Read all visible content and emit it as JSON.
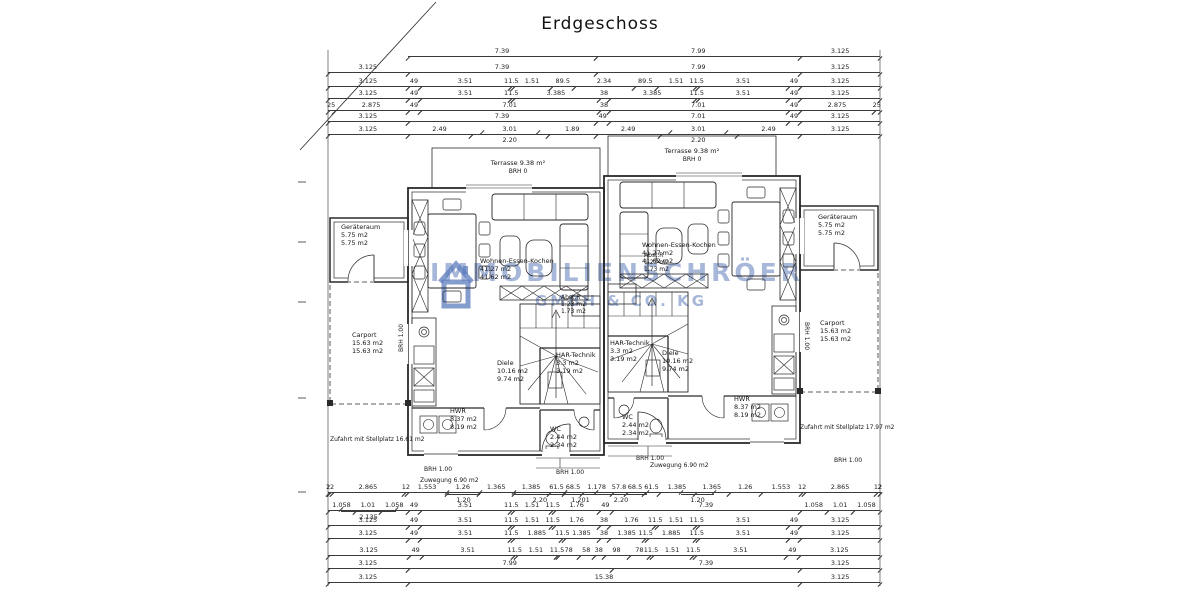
{
  "title": "Erdgeschoss",
  "watermark": {
    "part1": "IMMOBILIEN",
    "part2": "SCHRÖER",
    "sub": "GMBH & CO. KG",
    "color": "#5c7cbc"
  },
  "rooms": {
    "terrasse": {
      "name": "Terrasse 9.38 m²",
      "brh": "BRH 0"
    },
    "geraeteraum": {
      "name": "Geräteraum",
      "a1": "5.75 m2",
      "a2": "5.75 m2"
    },
    "carport": {
      "name": "Carport",
      "a1": "15.63 m2",
      "a2": "15.63 m2"
    },
    "wohnen": {
      "name": "Wohnen-Essen-Kochen",
      "a1": "41.27 m2",
      "a2": "41.62 m2"
    },
    "diele": {
      "name": "Diele",
      "a1": "10.16 m2",
      "a2": "9.74 m2"
    },
    "har": {
      "name": "HAR-Technik",
      "a1": "3.3 m2",
      "a2": "3.19 m2"
    },
    "hwr": {
      "name": "HWR",
      "a1": "8.37 m2",
      "a2": "8.19 m2"
    },
    "wc": {
      "name": "WC",
      "a1": "2.44 m2",
      "a2": "2.34 m2"
    },
    "abstr": {
      "name": "Abst.R",
      "a1": "1.23 m2",
      "a2": "1.73 m2"
    }
  },
  "site": {
    "zufahrt_links": "Zufahrt mit Stellplatz 16.61 m2",
    "zufahrt_rechts": "Zufahrt mit Stellplatz 17.97 m2",
    "zuwegung": "Zuwegung 6.90 m2",
    "brh_fenster": "BRH 1.00"
  },
  "dims": {
    "x0": 328,
    "x1": 880,
    "rows": [
      {
        "y": 48,
        "segs": [
          {
            "w": 3.125,
            "g": 1
          },
          {
            "l": "7.39",
            "w": 7.39
          },
          {
            "l": "7.99",
            "w": 7.99
          },
          {
            "l": "3.125",
            "w": 3.125
          }
        ]
      },
      {
        "y": 64,
        "segs": [
          {
            "l": "3.125",
            "w": 3.125
          },
          {
            "l": "7.39",
            "w": 7.39
          },
          {
            "l": "7.99",
            "w": 7.99
          },
          {
            "l": "3.125",
            "w": 3.125
          }
        ]
      },
      {
        "y": 78,
        "segs": [
          {
            "l": "3.125",
            "w": 3.125
          },
          {
            "l": "49",
            "w": 0.49
          },
          {
            "l": "3.51",
            "w": 3.51
          },
          {
            "l": "11.5",
            "w": 0.115
          },
          {
            "l": "1.51",
            "w": 1.51
          },
          {
            "l": "89.5",
            "w": 0.895
          },
          {
            "l": "2.34",
            "w": 2.34
          },
          {
            "l": "89.5",
            "w": 0.895
          },
          {
            "l": "1.51",
            "w": 1.51
          },
          {
            "l": "11.5",
            "w": 0.115
          },
          {
            "l": "3.51",
            "w": 3.51
          },
          {
            "l": "49",
            "w": 0.49
          },
          {
            "l": "3.125",
            "w": 3.125
          }
        ]
      },
      {
        "y": 90,
        "segs": [
          {
            "l": "3.125",
            "w": 3.125
          },
          {
            "l": "49",
            "w": 0.49
          },
          {
            "l": "3.51",
            "w": 3.51
          },
          {
            "l": "11.5",
            "w": 0.115
          },
          {
            "l": "3.385",
            "w": 3.385
          },
          {
            "l": "38",
            "w": 0.38
          },
          {
            "l": "3.385",
            "w": 3.385
          },
          {
            "l": "11.5",
            "w": 0.115
          },
          {
            "l": "3.51",
            "w": 3.51
          },
          {
            "l": "49",
            "w": 0.49
          },
          {
            "l": "3.125",
            "w": 3.125
          }
        ]
      },
      {
        "y": 102,
        "segs": [
          {
            "l": "25",
            "w": 0.25
          },
          {
            "l": "2.875",
            "w": 2.875
          },
          {
            "l": "49",
            "w": 0.49
          },
          {
            "l": "7.01",
            "w": 7.01
          },
          {
            "l": "38",
            "w": 0.38
          },
          {
            "l": "7.01",
            "w": 7.01
          },
          {
            "l": "49",
            "w": 0.49
          },
          {
            "l": "2.875",
            "w": 2.875
          },
          {
            "l": "25",
            "w": 0.25
          }
        ]
      },
      {
        "y": 113,
        "segs": [
          {
            "l": "3.125",
            "w": 3.125
          },
          {
            "l": "7.39",
            "w": 7.39
          },
          {
            "l": "49",
            "w": 0.49
          },
          {
            "l": "7.01",
            "w": 7.01
          },
          {
            "l": "49",
            "w": 0.49
          },
          {
            "l": "3.125",
            "w": 3.125
          }
        ]
      },
      {
        "y": 126,
        "segs": [
          {
            "l": "3.125",
            "w": 3.125
          },
          {
            "l": "2.49",
            "w": 2.49
          },
          {
            "l": "3.01",
            "w": 3.01
          },
          {
            "l": "1.89",
            "w": 1.89
          },
          {
            "l": "2.49",
            "w": 2.49
          },
          {
            "l": "3.01",
            "w": 3.01
          },
          {
            "l": "2.49",
            "w": 2.49
          },
          {
            "l": "3.125",
            "w": 3.125
          }
        ]
      },
      {
        "y": 134,
        "sub": true,
        "segs": [
          {
            "w": 6.02,
            "g": 1
          },
          {
            "l": "2.20",
            "w": 2.2
          },
          {
            "w": 5.19,
            "g": 1
          },
          {
            "l": "2.20",
            "w": 2.2
          },
          {
            "w": 6.02,
            "g": 1
          }
        ]
      },
      {
        "y": 484,
        "segs": [
          {
            "l": "2",
            "w": 0.02
          },
          {
            "l": "12",
            "w": 0.12
          },
          {
            "l": "2.865",
            "w": 2.865
          },
          {
            "l": "12",
            "w": 0.12
          },
          {
            "l": "1.553",
            "w": 1.553
          },
          {
            "l": "1.26",
            "w": 1.26
          },
          {
            "l": "1.365",
            "w": 1.365
          },
          {
            "l": "1.385",
            "w": 1.385
          },
          {
            "l": "61.5",
            "w": 0.615
          },
          {
            "l": "68.5",
            "w": 0.685
          },
          {
            "l": "1.178",
            "w": 1.178
          },
          {
            "l": "57.8",
            "w": 0.578
          },
          {
            "l": "68.5",
            "w": 0.685
          },
          {
            "l": "61.5",
            "w": 0.615
          },
          {
            "l": "1.385",
            "w": 1.385
          },
          {
            "l": "1.365",
            "w": 1.365
          },
          {
            "l": "1.26",
            "w": 1.26
          },
          {
            "l": "1.553",
            "w": 1.553
          },
          {
            "l": "12",
            "w": 0.12
          },
          {
            "l": "2.865",
            "w": 2.865
          },
          {
            "l": "12",
            "w": 0.12
          },
          {
            "l": "2",
            "w": 0.02
          }
        ]
      },
      {
        "y": 494,
        "sub": true,
        "segs": [
          {
            "w": 4.678,
            "g": 1
          },
          {
            "l": "1.20",
            "w": 1.26
          },
          {
            "w": 1.365,
            "g": 1
          },
          {
            "l": "2.20",
            "w": 2.0
          },
          {
            "l": "1.201",
            "w": 1.178
          },
          {
            "l": "2.20",
            "w": 2.0
          },
          {
            "w": 1.365,
            "g": 1
          },
          {
            "l": "1.20",
            "w": 1.26
          },
          {
            "w": 6.52,
            "g": 1
          }
        ]
      },
      {
        "y": 502,
        "segs": [
          {
            "l": "1.058",
            "w": 1.058
          },
          {
            "l": "1.01",
            "w": 1.01
          },
          {
            "l": "1.058",
            "w": 1.058
          },
          {
            "l": "49",
            "w": 0.49
          },
          {
            "l": "3.51",
            "w": 3.51
          },
          {
            "l": "11.5",
            "w": 0.115
          },
          {
            "l": "1.51",
            "w": 1.51
          },
          {
            "l": "11.5",
            "w": 0.115
          },
          {
            "l": "1.76",
            "w": 1.76
          },
          {
            "l": "49",
            "w": 0.49
          },
          {
            "l": "7.39",
            "w": 7.39
          },
          {
            "l": "1.058",
            "w": 1.058
          },
          {
            "l": "1.01",
            "w": 1.01
          },
          {
            "l": "1.058",
            "w": 1.058
          }
        ]
      },
      {
        "y": 511,
        "sub": true,
        "segs": [
          {
            "w": 0.52,
            "g": 1
          },
          {
            "l": "2.135",
            "w": 2.135
          },
          {
            "w": 18.975,
            "g": 1
          }
        ]
      },
      {
        "y": 517,
        "segs": [
          {
            "l": "3.125",
            "w": 3.125
          },
          {
            "l": "49",
            "w": 0.49
          },
          {
            "l": "3.51",
            "w": 3.51
          },
          {
            "l": "11.5",
            "w": 0.115
          },
          {
            "l": "1.51",
            "w": 1.51
          },
          {
            "l": "11.5",
            "w": 0.115
          },
          {
            "l": "1.76",
            "w": 1.76
          },
          {
            "l": "38",
            "w": 0.38
          },
          {
            "l": "1.76",
            "w": 1.76
          },
          {
            "l": "11.5",
            "w": 0.115
          },
          {
            "l": "1.51",
            "w": 1.51
          },
          {
            "l": "11.5",
            "w": 0.115
          },
          {
            "l": "3.51",
            "w": 3.51
          },
          {
            "l": "49",
            "w": 0.49
          },
          {
            "l": "3.125",
            "w": 3.125
          }
        ]
      },
      {
        "y": 530,
        "segs": [
          {
            "l": "3.125",
            "w": 3.125
          },
          {
            "l": "49",
            "w": 0.49
          },
          {
            "l": "3.51",
            "w": 3.51
          },
          {
            "l": "11.5",
            "w": 0.115
          },
          {
            "l": "1.885",
            "w": 1.885
          },
          {
            "l": "11.5",
            "w": 0.115
          },
          {
            "l": "1.385",
            "w": 1.385
          },
          {
            "l": "38",
            "w": 0.38
          },
          {
            "l": "1.385",
            "w": 1.385
          },
          {
            "l": "11.5",
            "w": 0.115
          },
          {
            "l": "1.885",
            "w": 1.885
          },
          {
            "l": "11.5",
            "w": 0.115
          },
          {
            "l": "3.51",
            "w": 3.51
          },
          {
            "l": "49",
            "w": 0.49
          },
          {
            "l": "3.125",
            "w": 3.125
          }
        ]
      },
      {
        "y": 547,
        "segs": [
          {
            "l": "3.125",
            "w": 3.125
          },
          {
            "l": "49",
            "w": 0.49
          },
          {
            "l": "3.51",
            "w": 3.51
          },
          {
            "l": "11.5",
            "w": 0.115
          },
          {
            "l": "1.51",
            "w": 1.51
          },
          {
            "l": "11.5",
            "w": 0.115
          },
          {
            "l": "78",
            "w": 0.78
          },
          {
            "l": "58",
            "w": 0.58
          },
          {
            "l": "38",
            "w": 0.38
          },
          {
            "l": "98",
            "w": 0.98
          },
          {
            "l": "78",
            "w": 0.78
          },
          {
            "l": "11.5",
            "w": 0.115
          },
          {
            "l": "1.51",
            "w": 1.51
          },
          {
            "l": "11.5",
            "w": 0.115
          },
          {
            "l": "3.51",
            "w": 3.51
          },
          {
            "l": "49",
            "w": 0.49
          },
          {
            "l": "3.125",
            "w": 3.125
          }
        ]
      },
      {
        "y": 560,
        "segs": [
          {
            "l": "3.125",
            "w": 3.125
          },
          {
            "l": "7.99",
            "w": 7.99
          },
          {
            "l": "7.39",
            "w": 7.39
          },
          {
            "l": "3.125",
            "w": 3.125
          }
        ]
      },
      {
        "y": 574,
        "segs": [
          {
            "l": "3.125",
            "w": 3.125
          },
          {
            "l": "15.38",
            "w": 15.38
          },
          {
            "l": "3.125",
            "w": 3.125
          }
        ]
      }
    ]
  }
}
